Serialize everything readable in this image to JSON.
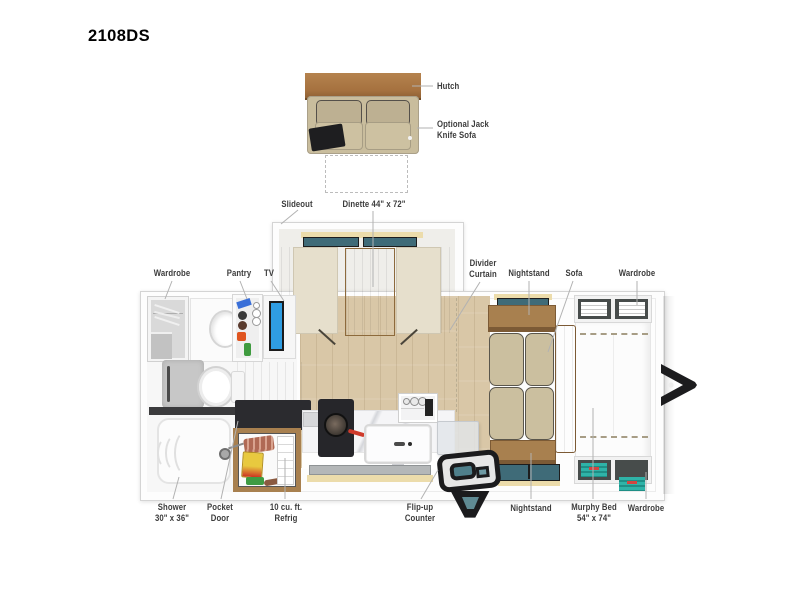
{
  "title": "2108DS",
  "floorplan": {
    "callouts": {
      "hutch": "Hutch",
      "optional_sofa": "Optional Jack\nKnife Sofa",
      "slideout": "Slideout",
      "dinette": "Dinette 44\" x 72\"",
      "wardrobe_front": "Wardrobe",
      "pantry": "Pantry",
      "tv": "TV",
      "divider_curtain": "Divider\nCurtain",
      "nightstand_top": "Nightstand",
      "sofa": "Sofa",
      "wardrobe_top": "Wardrobe",
      "shower": "Shower\n30\" x 36\"",
      "pocket_door": "Pocket\nDoor",
      "refrigerator": "10 cu. ft.\nRefrig",
      "flip_up_counter": "Flip-up\nCounter",
      "nightstand_bottom": "Nightstand",
      "murphy_bed": "Murphy Bed\n54\" x 74\"",
      "wardrobe_bottom": "Wardrobe"
    },
    "colors": {
      "label_text": "#3c3c3c",
      "leader_line": "#b2b2b2",
      "floor_wood": "#d9c7a7",
      "table_wood": "#c49b63",
      "cabinet_wood": "#a8804f",
      "sofa_cushion": "#cbbf9f",
      "bench_cushion": "#e6dfcc",
      "window_glass_teal": "#3f6b78",
      "valance_cream": "#ecdcab",
      "tv_screen_blue": "#2f9de2",
      "counter_dark": "#2b2b2f",
      "marble_counter": "#f5f5f7",
      "entry_door_black": "#1b1b1d",
      "wardrobe_clothes_teal": "#2fb3a8"
    }
  }
}
